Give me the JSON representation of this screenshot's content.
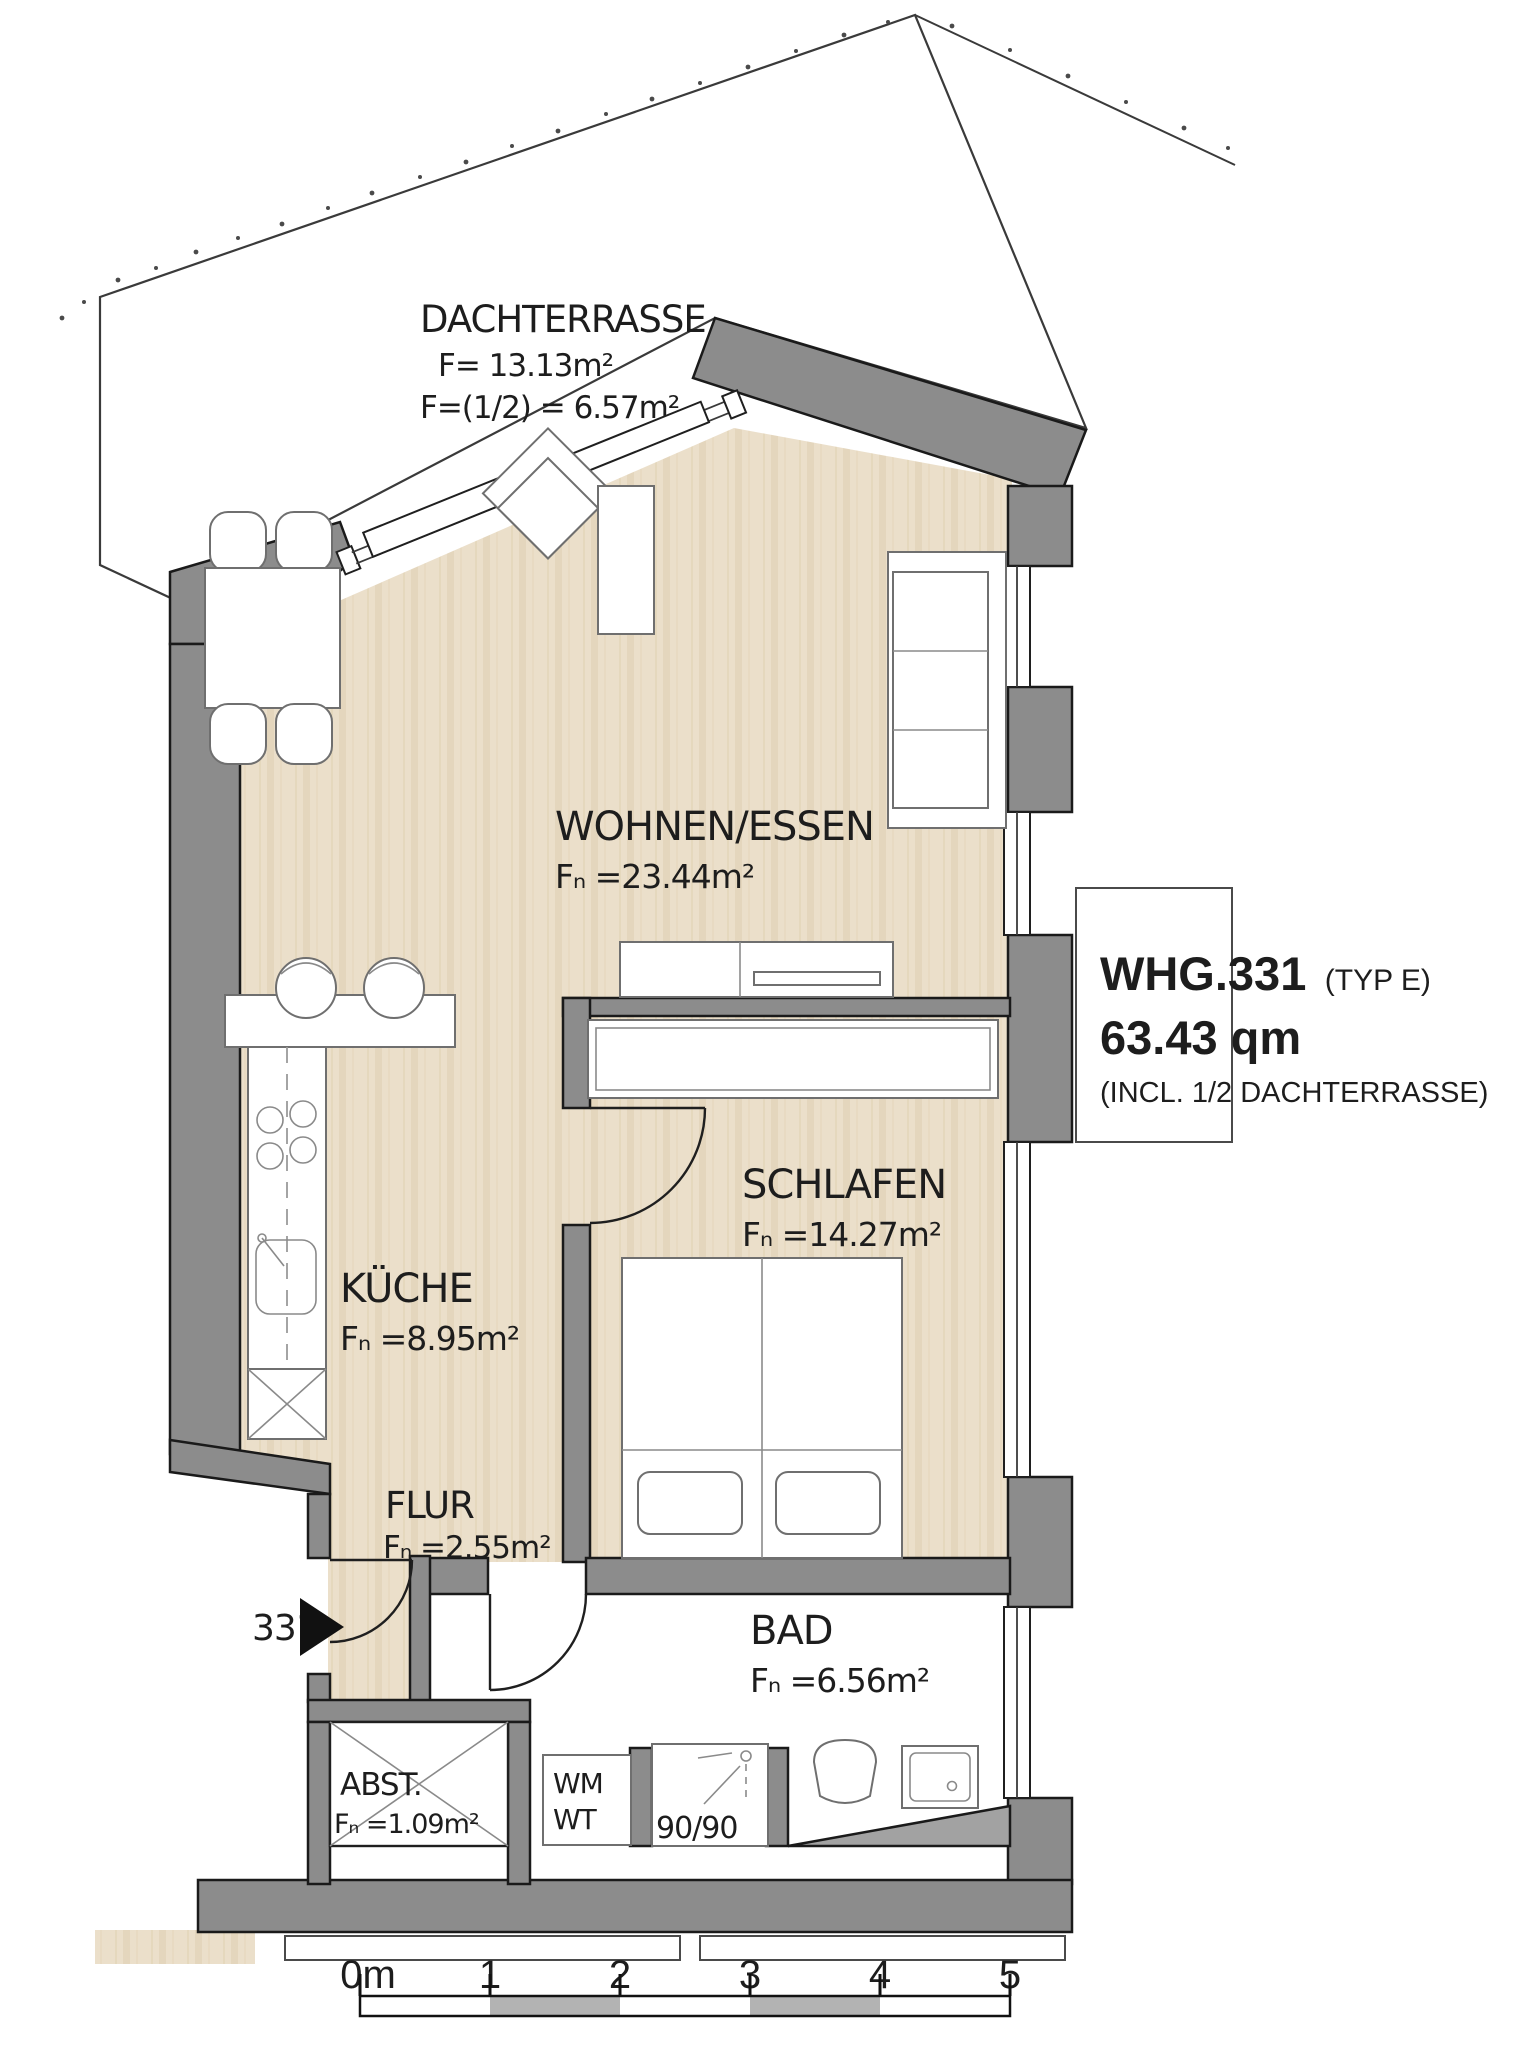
{
  "terrace": {
    "name": "DACHTERRASSE",
    "area": "F= 13.13m²",
    "half_area": "F=(1/2) = 6.57m²"
  },
  "rooms": {
    "living": {
      "name": "WOHNEN/ESSEN",
      "area": "Fₙ =23.44m²"
    },
    "bedroom": {
      "name": "SCHLAFEN",
      "area": "Fₙ =14.27m²"
    },
    "kitchen": {
      "name": "KÜCHE",
      "area": "Fₙ =8.95m²"
    },
    "hall": {
      "name": "FLUR",
      "area": "Fₙ =2.55m²"
    },
    "bath": {
      "name": "BAD",
      "area": "Fₙ =6.56m²"
    },
    "storage": {
      "name": "ABST.",
      "area": "Fₙ =1.09m²"
    }
  },
  "fixtures": {
    "washing_machine": "WM",
    "dryer": "WT",
    "shower_size": "90/90"
  },
  "entrance": {
    "unit_number": "331"
  },
  "title_block": {
    "unit": "WHG.331",
    "type": "(TYP E)",
    "total_area": "63.43 qm",
    "note": "(INCL. 1/2 DACHTERRASSE)"
  },
  "scale_bar": {
    "ticks": [
      "0m",
      "1",
      "2",
      "3",
      "4",
      "5"
    ]
  },
  "colors": {
    "wall": "#8c8c8c",
    "floor": "#ebdfca",
    "floor_stripe": "#dccbaa",
    "bath_floor": "#ffffff",
    "scale_gray": "#b3b3b3",
    "outline": "#1a1a1a"
  }
}
